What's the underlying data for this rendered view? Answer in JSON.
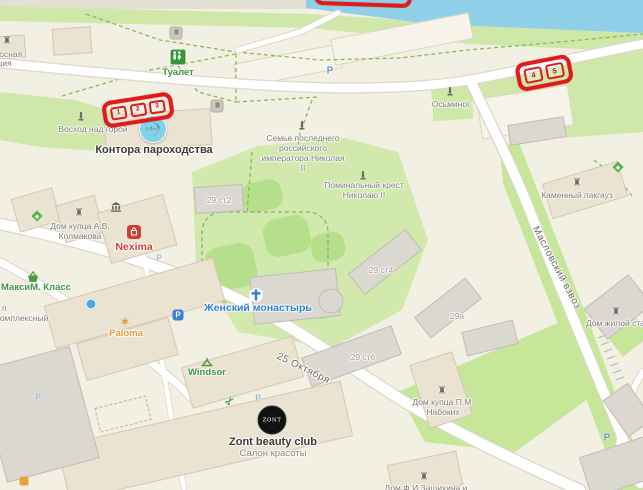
{
  "map_type": "city-map",
  "annotations": {
    "box1": {
      "markers": [
        "1",
        "2",
        "3"
      ]
    },
    "box2": {
      "markers": [
        "4",
        "5"
      ]
    }
  },
  "labels": {
    "pump_station_line1": "Насосная",
    "pump_station_line2": "станция",
    "toilet": "Туалет",
    "sunrise_monument": "Восход над горой",
    "steamship_office": "Контора пароходства",
    "imperial_family_line1": "Семье последнего",
    "imperial_family_line2": "российского",
    "imperial_family_line3": "императора Николая",
    "imperial_family_line4": "II",
    "memorial_cross_line1": "Поминальный крест",
    "memorial_cross_line2": "Николаю II",
    "octopus": "Осьминог",
    "stone_warehouse": "Каменный пакгауз",
    "street_maslovsky": "Масловский взвоз",
    "kolmakov_house_line1": "Дом купца А.В.",
    "kolmakov_house_line2": "Колмакова",
    "nexima": "Nexima",
    "bldg_29s2": "29 ст2",
    "maxim_class": "МаксиМ. Класс",
    "partial_p": "п",
    "kompleksny": "комплексный",
    "convent": "Женский монастырь",
    "bldg_29s4": "29 ст4",
    "bldg_29a": "29а",
    "bldg_29s6": "29 ст6",
    "paloma": "Paloma",
    "windsor": "Windsor",
    "street_october": "25 Октября",
    "zont_logo": "ZONT",
    "zont_title": "Zont beauty club",
    "zont_subtitle": "Салон красоты",
    "nabokikh_house_line1": "Дом купца П.М.",
    "nabokikh_house_line2": "Набоких",
    "residential_station_house": "Дом жилой станц",
    "zashikhin_house": "Дом Ф.И.Зашихина и",
    "parking": "P"
  },
  "glyphs": {
    "anchor": "⚓",
    "castle": "♜",
    "scissors": "✂",
    "star": "✶"
  },
  "icons": [
    "wc-icon",
    "anchor-icon",
    "monument-icon",
    "church-cross-icon",
    "castle-icon",
    "bank-columns-icon",
    "shopping-bag-icon",
    "basket-icon",
    "parking-icon",
    "scissors-icon",
    "diamond-poi-icon",
    "dot-poi-icon",
    "star-poi-icon",
    "zont-logo-icon"
  ],
  "colors": {
    "annotation_red": "#e01b1b",
    "water": "#8fd0e8",
    "green_area": "#cfe8aa",
    "green_lawn": "#b5df8a",
    "land": "#f2efe3",
    "road": "#ffffff",
    "building": "#eae3d2",
    "building_gray": "#dbd8d1",
    "poi_green": "#3e9440",
    "poi_blue": "#2f7ed8",
    "poi_red": "#d23c32",
    "poi_gray": "#7d7a70",
    "street_text": "#6e6a5e"
  }
}
